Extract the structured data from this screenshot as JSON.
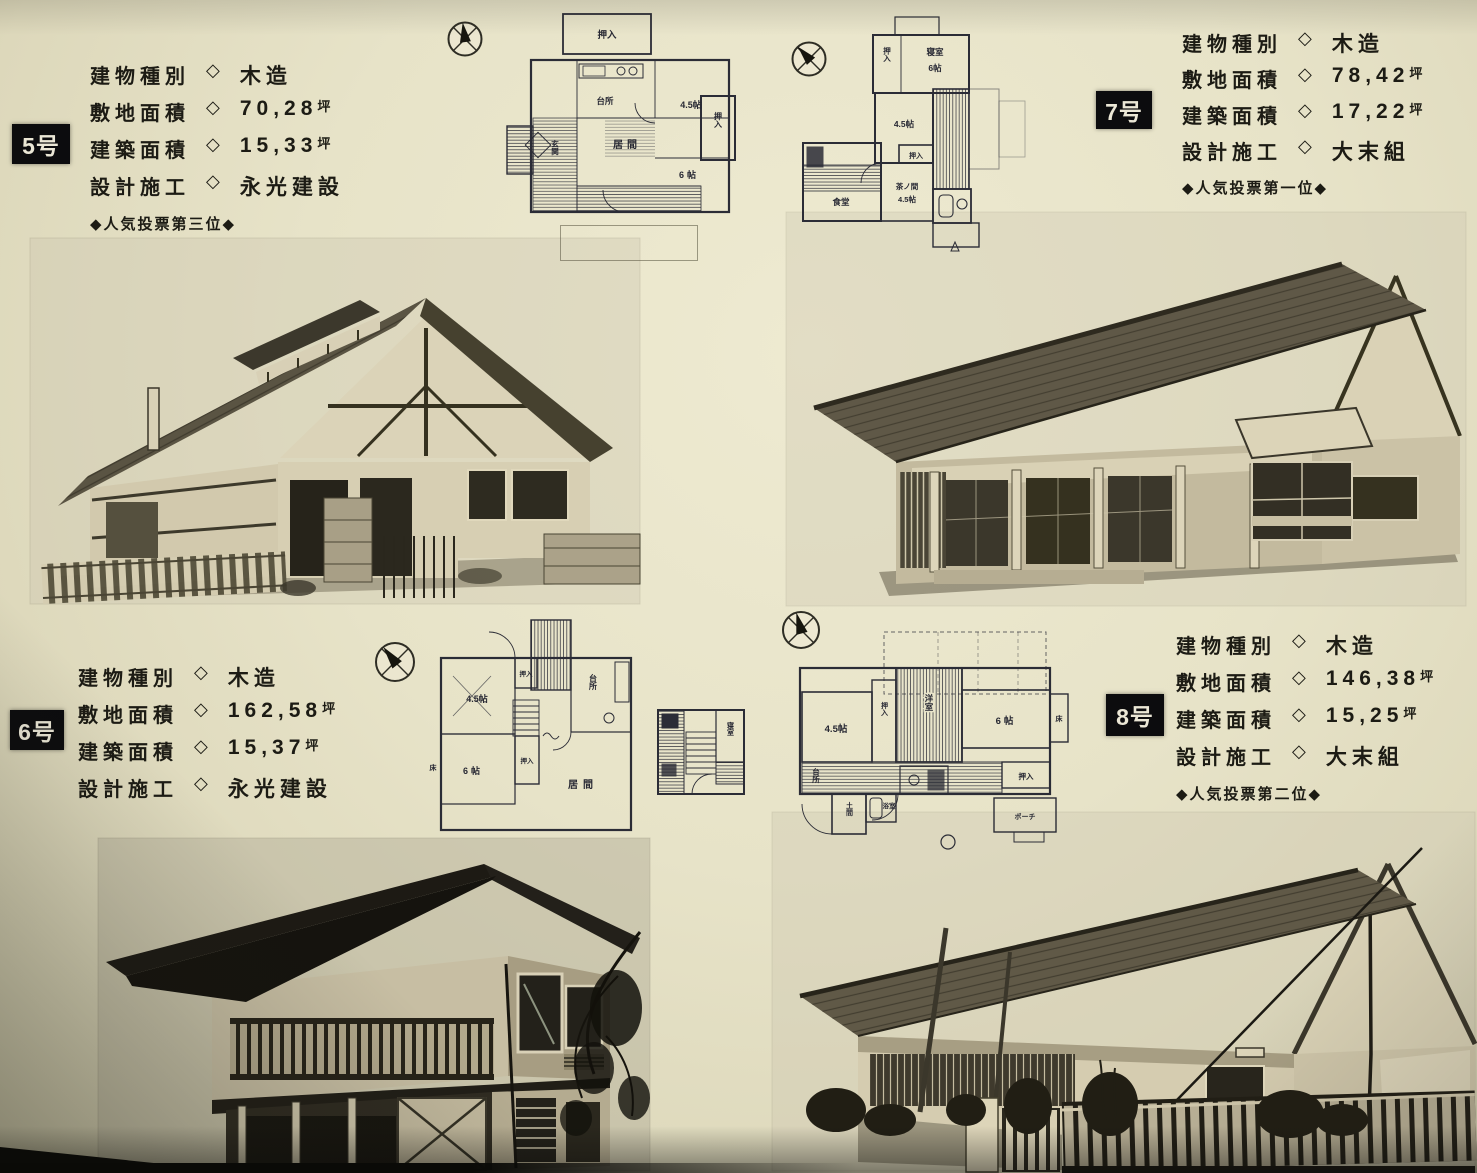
{
  "sep": "◇",
  "houses": [
    {
      "number": "5号",
      "specs": [
        {
          "label": "建物種別",
          "value": "木造",
          "unit": ""
        },
        {
          "label": "敷地面積",
          "value": "70,28",
          "unit": "坪"
        },
        {
          "label": "建築面積",
          "value": "15,33",
          "unit": "坪"
        },
        {
          "label": "設計施工",
          "value": "永光建設",
          "unit": ""
        }
      ],
      "ranking": "◆人気投票第三位◆",
      "rooms": {
        "oshiire_top": "押入",
        "daidokoro": "台所",
        "r45": "4.5帖",
        "ima": "居間",
        "r6": "6帖",
        "oshiire": "押入",
        "genkan": "玄関"
      }
    },
    {
      "number": "6号",
      "specs": [
        {
          "label": "建物種別",
          "value": "木造",
          "unit": ""
        },
        {
          "label": "敷地面積",
          "value": "162,58",
          "unit": "坪"
        },
        {
          "label": "建築面積",
          "value": "15,37",
          "unit": "坪"
        },
        {
          "label": "設計施工",
          "value": "永光建設",
          "unit": ""
        }
      ],
      "ranking": "",
      "rooms": {
        "r45": "4.5帖",
        "oshiire_top": "押入",
        "daidokoro": "台所",
        "r6": "6帖",
        "oshiire": "押入",
        "ima": "居間",
        "toko": "床",
        "shinshitsu": "寝室"
      }
    },
    {
      "number": "7号",
      "specs": [
        {
          "label": "建物種別",
          "value": "木造",
          "unit": ""
        },
        {
          "label": "敷地面積",
          "value": "78,42",
          "unit": "坪"
        },
        {
          "label": "建築面積",
          "value": "17,22",
          "unit": "坪"
        },
        {
          "label": "設計施工",
          "value": "大末組",
          "unit": ""
        }
      ],
      "ranking": "◆人気投票第一位◆",
      "rooms": {
        "shinshitsu": "寝室",
        "r6": "6帖",
        "oshiire1": "押入",
        "r45": "4.5帖",
        "oshiire2": "押入",
        "shokudo": "食堂",
        "chanoma": "茶ノ間",
        "chanoma_size": "4.5帖"
      }
    },
    {
      "number": "8号",
      "specs": [
        {
          "label": "建物種別",
          "value": "木造",
          "unit": ""
        },
        {
          "label": "敷地面積",
          "value": "146,38",
          "unit": "坪"
        },
        {
          "label": "建築面積",
          "value": "15,25",
          "unit": "坪"
        },
        {
          "label": "設計施工",
          "value": "大末組",
          "unit": ""
        }
      ],
      "ranking": "◆人気投票第二位◆",
      "rooms": {
        "r45": "4.5帖",
        "oshiire1": "押入",
        "yoshitsu": "洋室",
        "r6": "6帖",
        "toko": "床",
        "daidokoro": "台所",
        "doma": "土間",
        "yokushitsu": "浴室",
        "oshiire2": "押入",
        "porch": "ポーチ"
      }
    }
  ]
}
